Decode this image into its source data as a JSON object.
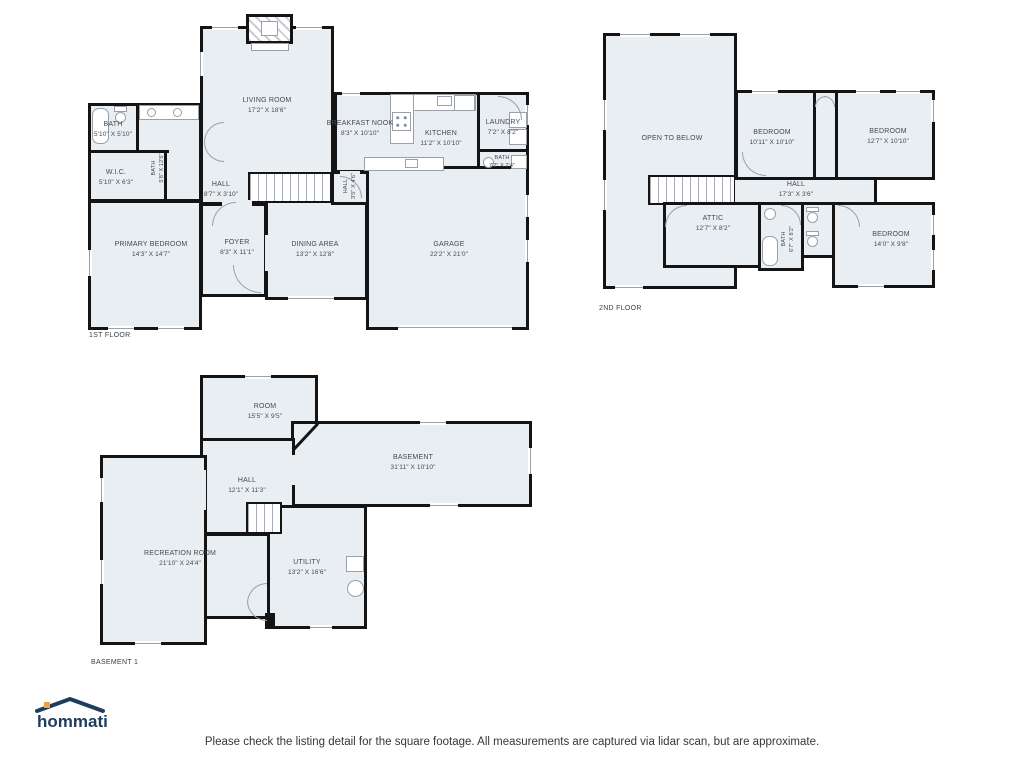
{
  "colors": {
    "wall": "#141414",
    "room_fill": "#e9eef2",
    "fixture_line": "#9aa0a8",
    "label_text": "#45494e",
    "logo_navy": "#1f3b5e",
    "logo_orange": "#f2a03d"
  },
  "floors": [
    {
      "id": "first",
      "caption": "1ST FLOOR",
      "rooms": [
        {
          "name": "LIVING ROOM",
          "dims": "17'2\" X 18'6\"",
          "x": 267,
          "y": 106
        },
        {
          "name": "BREAKFAST NOOK",
          "dims": "8'3\" X 10'10\"",
          "x": 360,
          "y": 129
        },
        {
          "name": "KITCHEN",
          "dims": "11'2\" X 10'10\"",
          "x": 441,
          "y": 139
        },
        {
          "name": "LAUNDRY",
          "dims": "7'2\" X 8'2\"",
          "x": 503,
          "y": 128
        },
        {
          "name": "BATH",
          "dims": "7'2\" X 2'4\"",
          "x": 502,
          "y": 163,
          "small": true
        },
        {
          "name": "BATH",
          "dims": "5'10\" X 5'10\"",
          "x": 113,
          "y": 130
        },
        {
          "name": "W.I.C.",
          "dims": "5'10\" X 6'3\"",
          "x": 116,
          "y": 178
        },
        {
          "name": "BATH",
          "dims": "5'8\" X 12'5\"",
          "x": 159,
          "y": 168,
          "rotate": true,
          "small": true
        },
        {
          "name": "HALL",
          "dims": "8'7\" X 3'10\"",
          "x": 221,
          "y": 190
        },
        {
          "name": "HALL",
          "dims": "3'5\" X 4'6\"",
          "x": 351,
          "y": 186,
          "rotate": true,
          "small": true
        },
        {
          "name": "FOYER",
          "dims": "8'3\" X 11'1\"",
          "x": 237,
          "y": 248
        },
        {
          "name": "PRIMARY BEDROOM",
          "dims": "14'3\" X 14'7\"",
          "x": 151,
          "y": 250
        },
        {
          "name": "DINING AREA",
          "dims": "13'2\" X 12'8\"",
          "x": 315,
          "y": 250
        },
        {
          "name": "GARAGE",
          "dims": "22'2\" X 21'0\"",
          "x": 449,
          "y": 250
        }
      ]
    },
    {
      "id": "second",
      "caption": "2ND FLOOR",
      "rooms": [
        {
          "name": "OPEN TO BELOW",
          "dims": "",
          "x": 672,
          "y": 139
        },
        {
          "name": "BEDROOM",
          "dims": "10'11\" X 10'10\"",
          "x": 772,
          "y": 138
        },
        {
          "name": "BEDROOM",
          "dims": "12'7\" X 10'10\"",
          "x": 888,
          "y": 137
        },
        {
          "name": "HALL",
          "dims": "17'3\" X 3'6\"",
          "x": 796,
          "y": 190
        },
        {
          "name": "ATTIC",
          "dims": "12'7\" X 8'2\"",
          "x": 713,
          "y": 224
        },
        {
          "name": "BATH",
          "dims": "6'7\" X 8'2\"",
          "x": 789,
          "y": 239,
          "rotate": true,
          "small": true
        },
        {
          "name": "BEDROOM",
          "dims": "14'0\" X 9'8\"",
          "x": 891,
          "y": 240
        }
      ]
    },
    {
      "id": "basement",
      "caption": "BASEMENT 1",
      "rooms": [
        {
          "name": "ROOM",
          "dims": "15'5\" X 9'5\"",
          "x": 265,
          "y": 412
        },
        {
          "name": "BASEMENT",
          "dims": "31'11\" X 10'10\"",
          "x": 413,
          "y": 463
        },
        {
          "name": "HALL",
          "dims": "12'1\" X 11'3\"",
          "x": 247,
          "y": 486
        },
        {
          "name": "RECREATION ROOM",
          "dims": "21'10\" X 24'4\"",
          "x": 180,
          "y": 559
        },
        {
          "name": "UTILITY",
          "dims": "13'2\" X 16'6\"",
          "x": 307,
          "y": 568
        }
      ]
    }
  ],
  "footer": {
    "logo_text": "hommati",
    "disclaimer": "Please check the listing detail for the square footage. All measurements are captured via lidar scan, but are approximate."
  }
}
